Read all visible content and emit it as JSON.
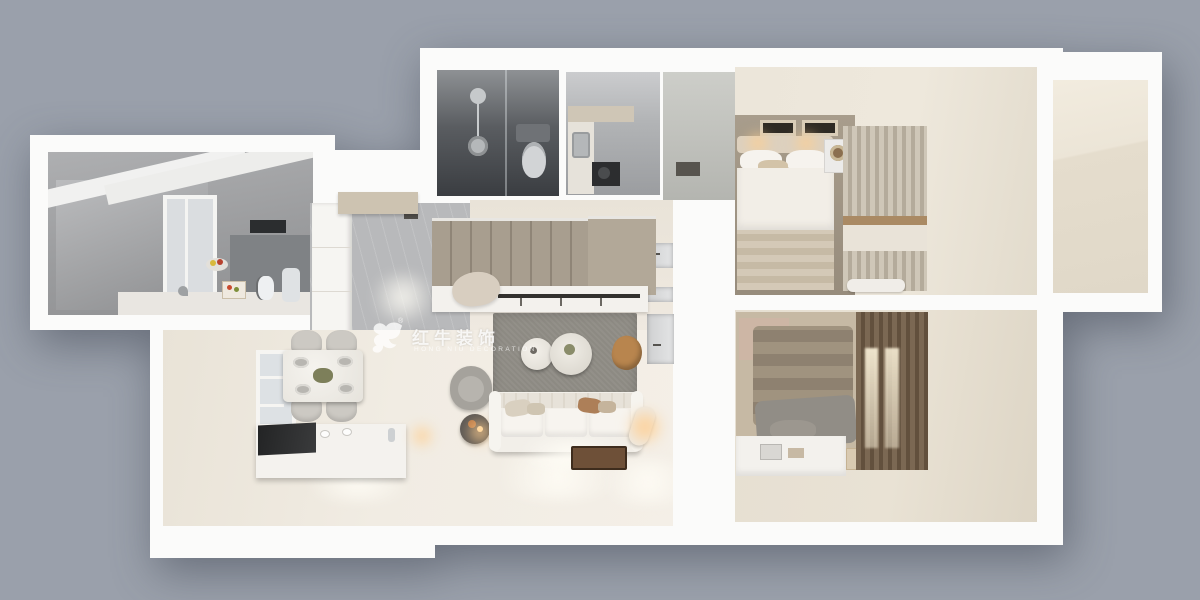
{
  "scene": {
    "type": "3d-floorplan-top-down-render",
    "style": "photorealistic interior visualization on plain grey backdrop",
    "rooms": [
      "kitchen-wing",
      "entry-hall",
      "dark-bathroom-with-shower-and-toilet",
      "kitchenette-pantry",
      "upper-hallway",
      "master-bedroom",
      "second-bedroom",
      "staircase",
      "living-room",
      "dining-area",
      "empty-annex-room"
    ],
    "furniture": [
      "white-three-seat-sofa",
      "grey-area-rug",
      "two-round-coffee-tables",
      "grey-armchair",
      "dark-side-table-with-lamp",
      "wood-stool",
      "floor-lamp",
      "marble-dining-table-with-four-chairs",
      "white-island-bench",
      "window",
      "double-bed-white-bedding",
      "double-bed-brown-bedding",
      "desk",
      "curtains",
      "shower-set",
      "toilet",
      "cooktop",
      "stairs-with-landing",
      "wardrobe-rail"
    ]
  },
  "watermark": {
    "logo": "bull-logo",
    "registered_mark": "®",
    "title": "红牛装饰",
    "subtitle": "HONG NIU DECORATION"
  },
  "colors": {
    "bg": "#9aa0ab",
    "wall": "#fbfbfa",
    "floor_cream": "#f1ece3",
    "floor_cream_dark": "#e6dfd2",
    "tile_grey": "#b8b9bb",
    "bath_dark": "#3a3d41",
    "stairs_tan": "#a89e8f",
    "rug_grey": "#8d8a83",
    "sofa_white": "#f2efe9",
    "wood_floor": "#978c7c",
    "curtain_beige": "#cfc7b8",
    "curtain_brown": "#7b6853",
    "bed_brown": "#a0937f",
    "accent_wood": "#b8854e",
    "glow_warm": "#ffcf94"
  }
}
